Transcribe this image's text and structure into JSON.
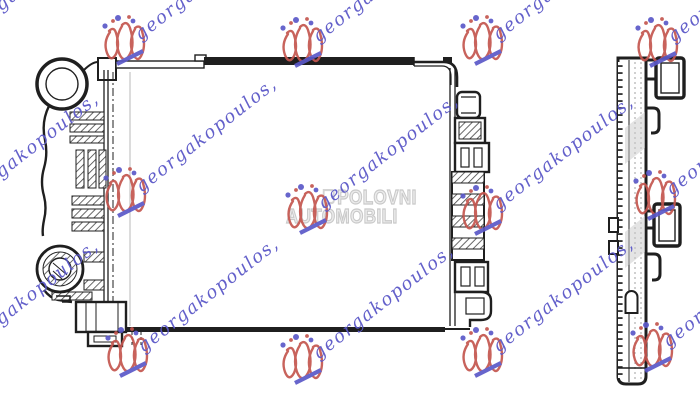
{
  "image": {
    "background": "#ffffff",
    "line_color": "#1f1f1f",
    "subject": "radiator technical line drawing"
  },
  "drawing": {
    "front_view": "radiator-front-view",
    "side_view": "radiator-side-profile-view"
  },
  "seller_watermark": {
    "text": "georgakopoulos,",
    "text_color": "#5b58c8",
    "logo_color": "#c4564f",
    "logo_icon": "red-scribble-figures-with-blue-dots-and-slash",
    "angle_deg": -38,
    "positions": [
      {
        "x": -55,
        "y": 38
      },
      {
        "x": 122,
        "y": 38
      },
      {
        "x": 300,
        "y": 40
      },
      {
        "x": 480,
        "y": 38
      },
      {
        "x": 655,
        "y": 40
      },
      {
        "x": -55,
        "y": 205
      },
      {
        "x": 123,
        "y": 190
      },
      {
        "x": 305,
        "y": 207
      },
      {
        "x": 480,
        "y": 208
      },
      {
        "x": 653,
        "y": 193
      },
      {
        "x": -55,
        "y": 352
      },
      {
        "x": 125,
        "y": 350
      },
      {
        "x": 300,
        "y": 357
      },
      {
        "x": 480,
        "y": 350
      },
      {
        "x": 650,
        "y": 345
      }
    ]
  },
  "site_watermark": {
    "line1": "POLOVNI",
    "line2": "AUTOMOBILI",
    "color": "#c9c9c9",
    "logo_icon": "polovni-automobili-mark"
  }
}
